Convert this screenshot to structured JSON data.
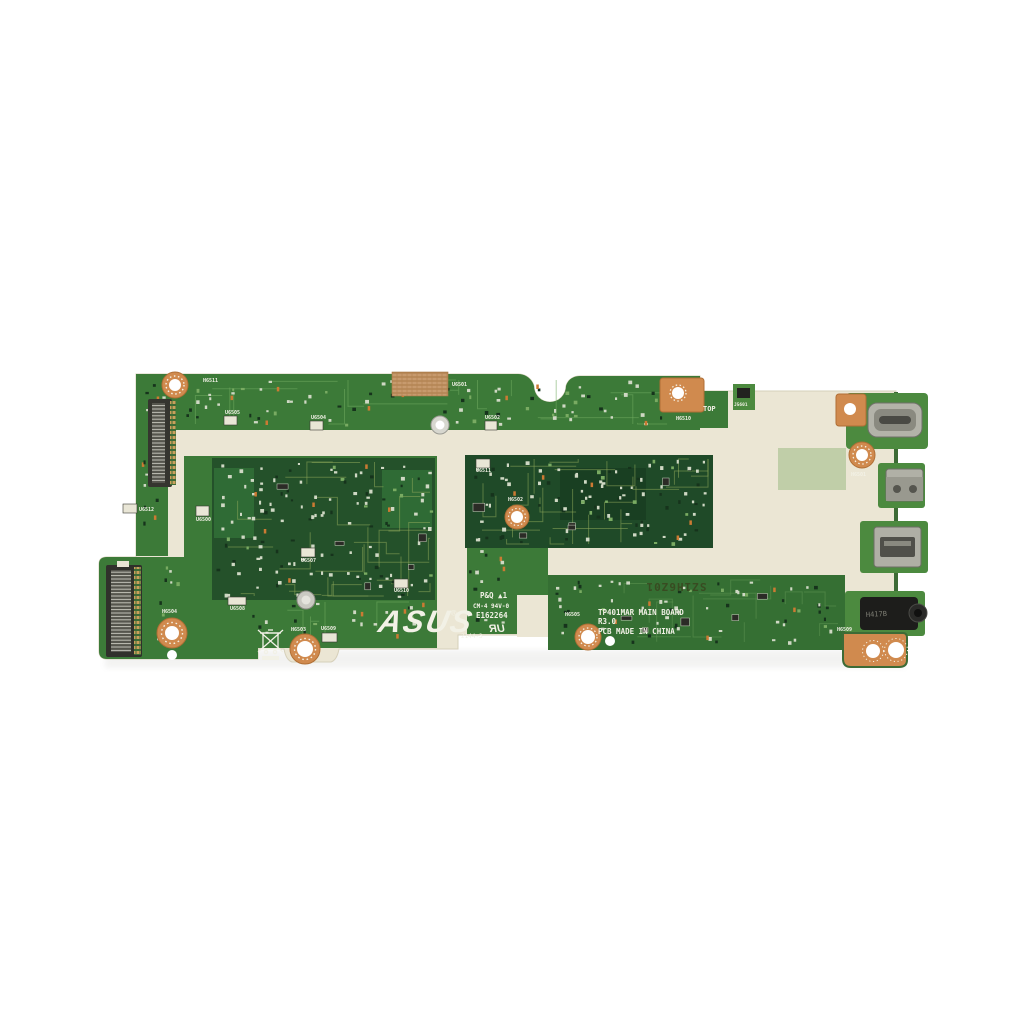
{
  "meta": {
    "subject": "ASUS TP401MAR laptop main board (motherboard) product photo, top view",
    "background_color": "#ffffff"
  },
  "board": {
    "brand": "ASUS",
    "registered": "®",
    "model": "TP401MAR MAIN BOARD",
    "revision": "R3.0",
    "origin": "PCB MADE IN CHINA",
    "orientation_marking": "TOP",
    "compliance": {
      "pq_mark": "P&Q ▲1",
      "flammability": "CM-4 94V-0",
      "ul_file": "E162264",
      "ul_mark": "UR",
      "date_code": "2144-3",
      "stamp": "SZ1H6Z01"
    },
    "audio_jack_marking": "H417B"
  },
  "colors": {
    "substrate": "#ebe6d4",
    "green_mid": "#3c7a38",
    "green_mid2": "#356f33",
    "green_dark": "#24512a",
    "green_dark2": "#1f4a28",
    "green_light": "#5d9a50",
    "island_green": "#4c8a3f",
    "copper": "#d08a4e",
    "silkscreen": "#f2f1e6",
    "metal": "#b3b3a9",
    "stamp_ink": "#39451f"
  },
  "ports": [
    {
      "name": "usb-c-port"
    },
    {
      "name": "micro-usb-port"
    },
    {
      "name": "micro-hdmi-port"
    },
    {
      "name": "audio-jack"
    }
  ],
  "silkscreen_labels": [
    {
      "t": "H6511",
      "x": 203,
      "y": 382
    },
    {
      "t": "U6505",
      "x": 225,
      "y": 414,
      "box": [
        224,
        416,
        13,
        9
      ]
    },
    {
      "t": "U6504",
      "x": 311,
      "y": 419,
      "box": [
        310,
        421,
        13,
        9
      ]
    },
    {
      "t": "U6501",
      "x": 452,
      "y": 386
    },
    {
      "t": "U6502",
      "x": 485,
      "y": 419,
      "box": [
        485,
        421,
        12,
        9
      ]
    },
    {
      "t": "H6510",
      "x": 676,
      "y": 420
    },
    {
      "t": "TOP",
      "x": 703,
      "y": 411,
      "size": 7
    },
    {
      "t": "J5601",
      "x": 734,
      "y": 406,
      "size": 4.5
    },
    {
      "t": "U6512",
      "x": 139,
      "y": 511,
      "box": [
        123,
        504,
        14,
        9
      ]
    },
    {
      "t": "U6500",
      "x": 196,
      "y": 521,
      "box": [
        196,
        506,
        13,
        10
      ]
    },
    {
      "t": "U6507",
      "x": 301,
      "y": 562,
      "box": [
        301,
        548,
        14,
        9
      ]
    },
    {
      "t": "U6510",
      "x": 394,
      "y": 592,
      "box": [
        394,
        579,
        14,
        9
      ]
    },
    {
      "t": "U6511",
      "x": 476,
      "y": 472,
      "box": [
        476,
        459,
        14,
        9
      ]
    },
    {
      "t": "H6502",
      "x": 508,
      "y": 501
    },
    {
      "t": "U6508",
      "x": 230,
      "y": 610,
      "box": [
        228,
        597,
        18,
        8
      ]
    },
    {
      "t": "H6503",
      "x": 291,
      "y": 631
    },
    {
      "t": "U6509",
      "x": 321,
      "y": 630,
      "box": [
        322,
        633,
        15,
        9
      ]
    },
    {
      "t": "H6504",
      "x": 162,
      "y": 613
    },
    {
      "t": "H6505",
      "x": 565,
      "y": 616
    },
    {
      "t": "H6501",
      "x": 851,
      "y": 476
    },
    {
      "t": "H6509",
      "x": 837,
      "y": 631
    }
  ]
}
